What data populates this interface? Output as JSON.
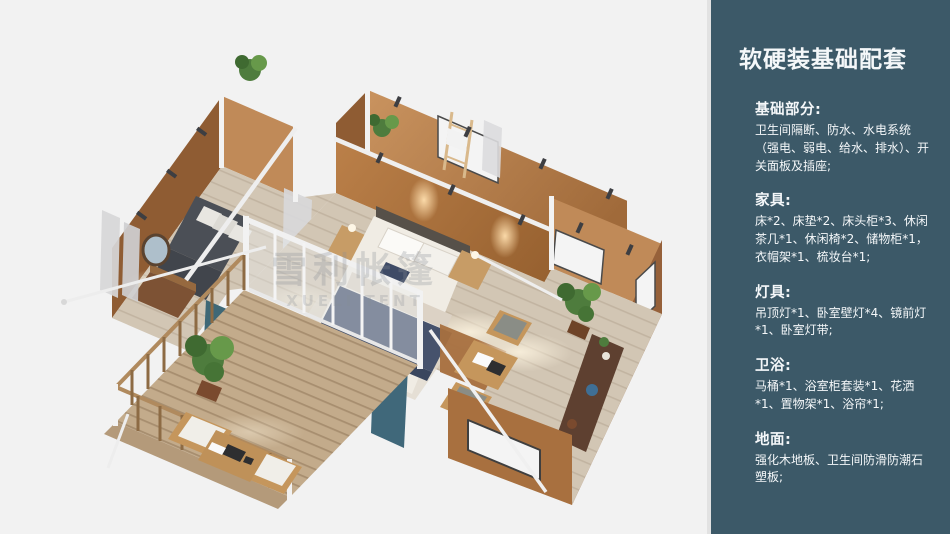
{
  "panel": {
    "title": "软硬装基础配套",
    "sections": [
      {
        "heading": "基础部分:",
        "body": "卫生间隔断、防水、水电系统（强电、弱电、给水、排水）、开关面板及插座;"
      },
      {
        "heading": "家具:",
        "body": "床*2、床垫*2、床头柜*3、休闲茶几*1、休闲椅*2、储物柜*1，衣帽架*1、梳妆台*1;"
      },
      {
        "heading": "灯具:",
        "body": "吊顶灯*1、卧室壁灯*4、镜前灯*1、卧室灯带;"
      },
      {
        "heading": "卫浴:",
        "body": "马桶*1、浴室柜套装*1、花洒*1、置物架*1、浴帘*1;"
      },
      {
        "heading": "地面:",
        "body": "强化木地板、卫生间防滑防潮石塑板;"
      }
    ]
  },
  "watermark": {
    "line1": "雪利帐篷",
    "line2": "XUELI TENT"
  },
  "colors": {
    "panel_bg": "#3c5968",
    "wall_copper": "#a8703f",
    "wall_copper_light": "#c08a58",
    "floor_wood": "#d2c6b4",
    "deck_wood": "#c3ab8b",
    "bed_navy": "#46526c",
    "curtain_teal": "#40687a",
    "plant_green": "#4e7c3d",
    "frame_white": "#f1f1f1"
  }
}
